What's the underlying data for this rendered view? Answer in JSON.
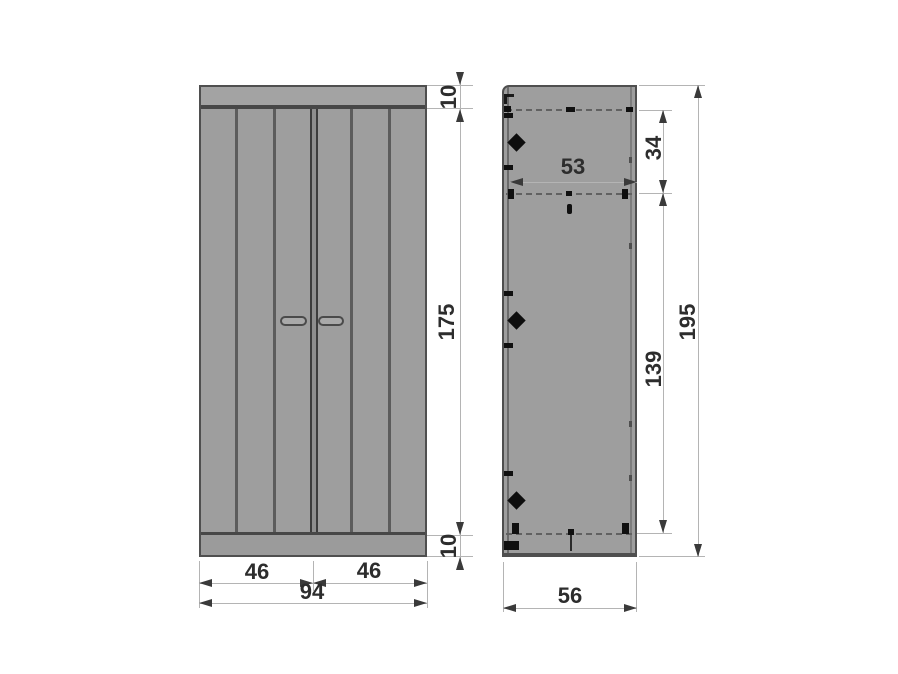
{
  "drawing": {
    "type": "furniture dimension diagram (2-door wardrobe, front and side views)",
    "front_view": {
      "dimensions": {
        "top_rail_thickness": "10",
        "door_height": "175",
        "bottom_rail_thickness": "10",
        "left_door_width": "46",
        "right_door_width": "46",
        "overall_width": "94"
      }
    },
    "side_view": {
      "dimensions": {
        "inner_depth": "53",
        "top_shelf_spacing": "34",
        "interior_height": "139",
        "overall_height": "195",
        "overall_depth": "56"
      }
    },
    "colors": {
      "panel_fill": "#9e9e9e",
      "panel_edge": "#4f4f4f",
      "dimension_line": "#b4b4b4",
      "dimension_text": "#2d2d2d",
      "background": "#ffffff"
    }
  }
}
